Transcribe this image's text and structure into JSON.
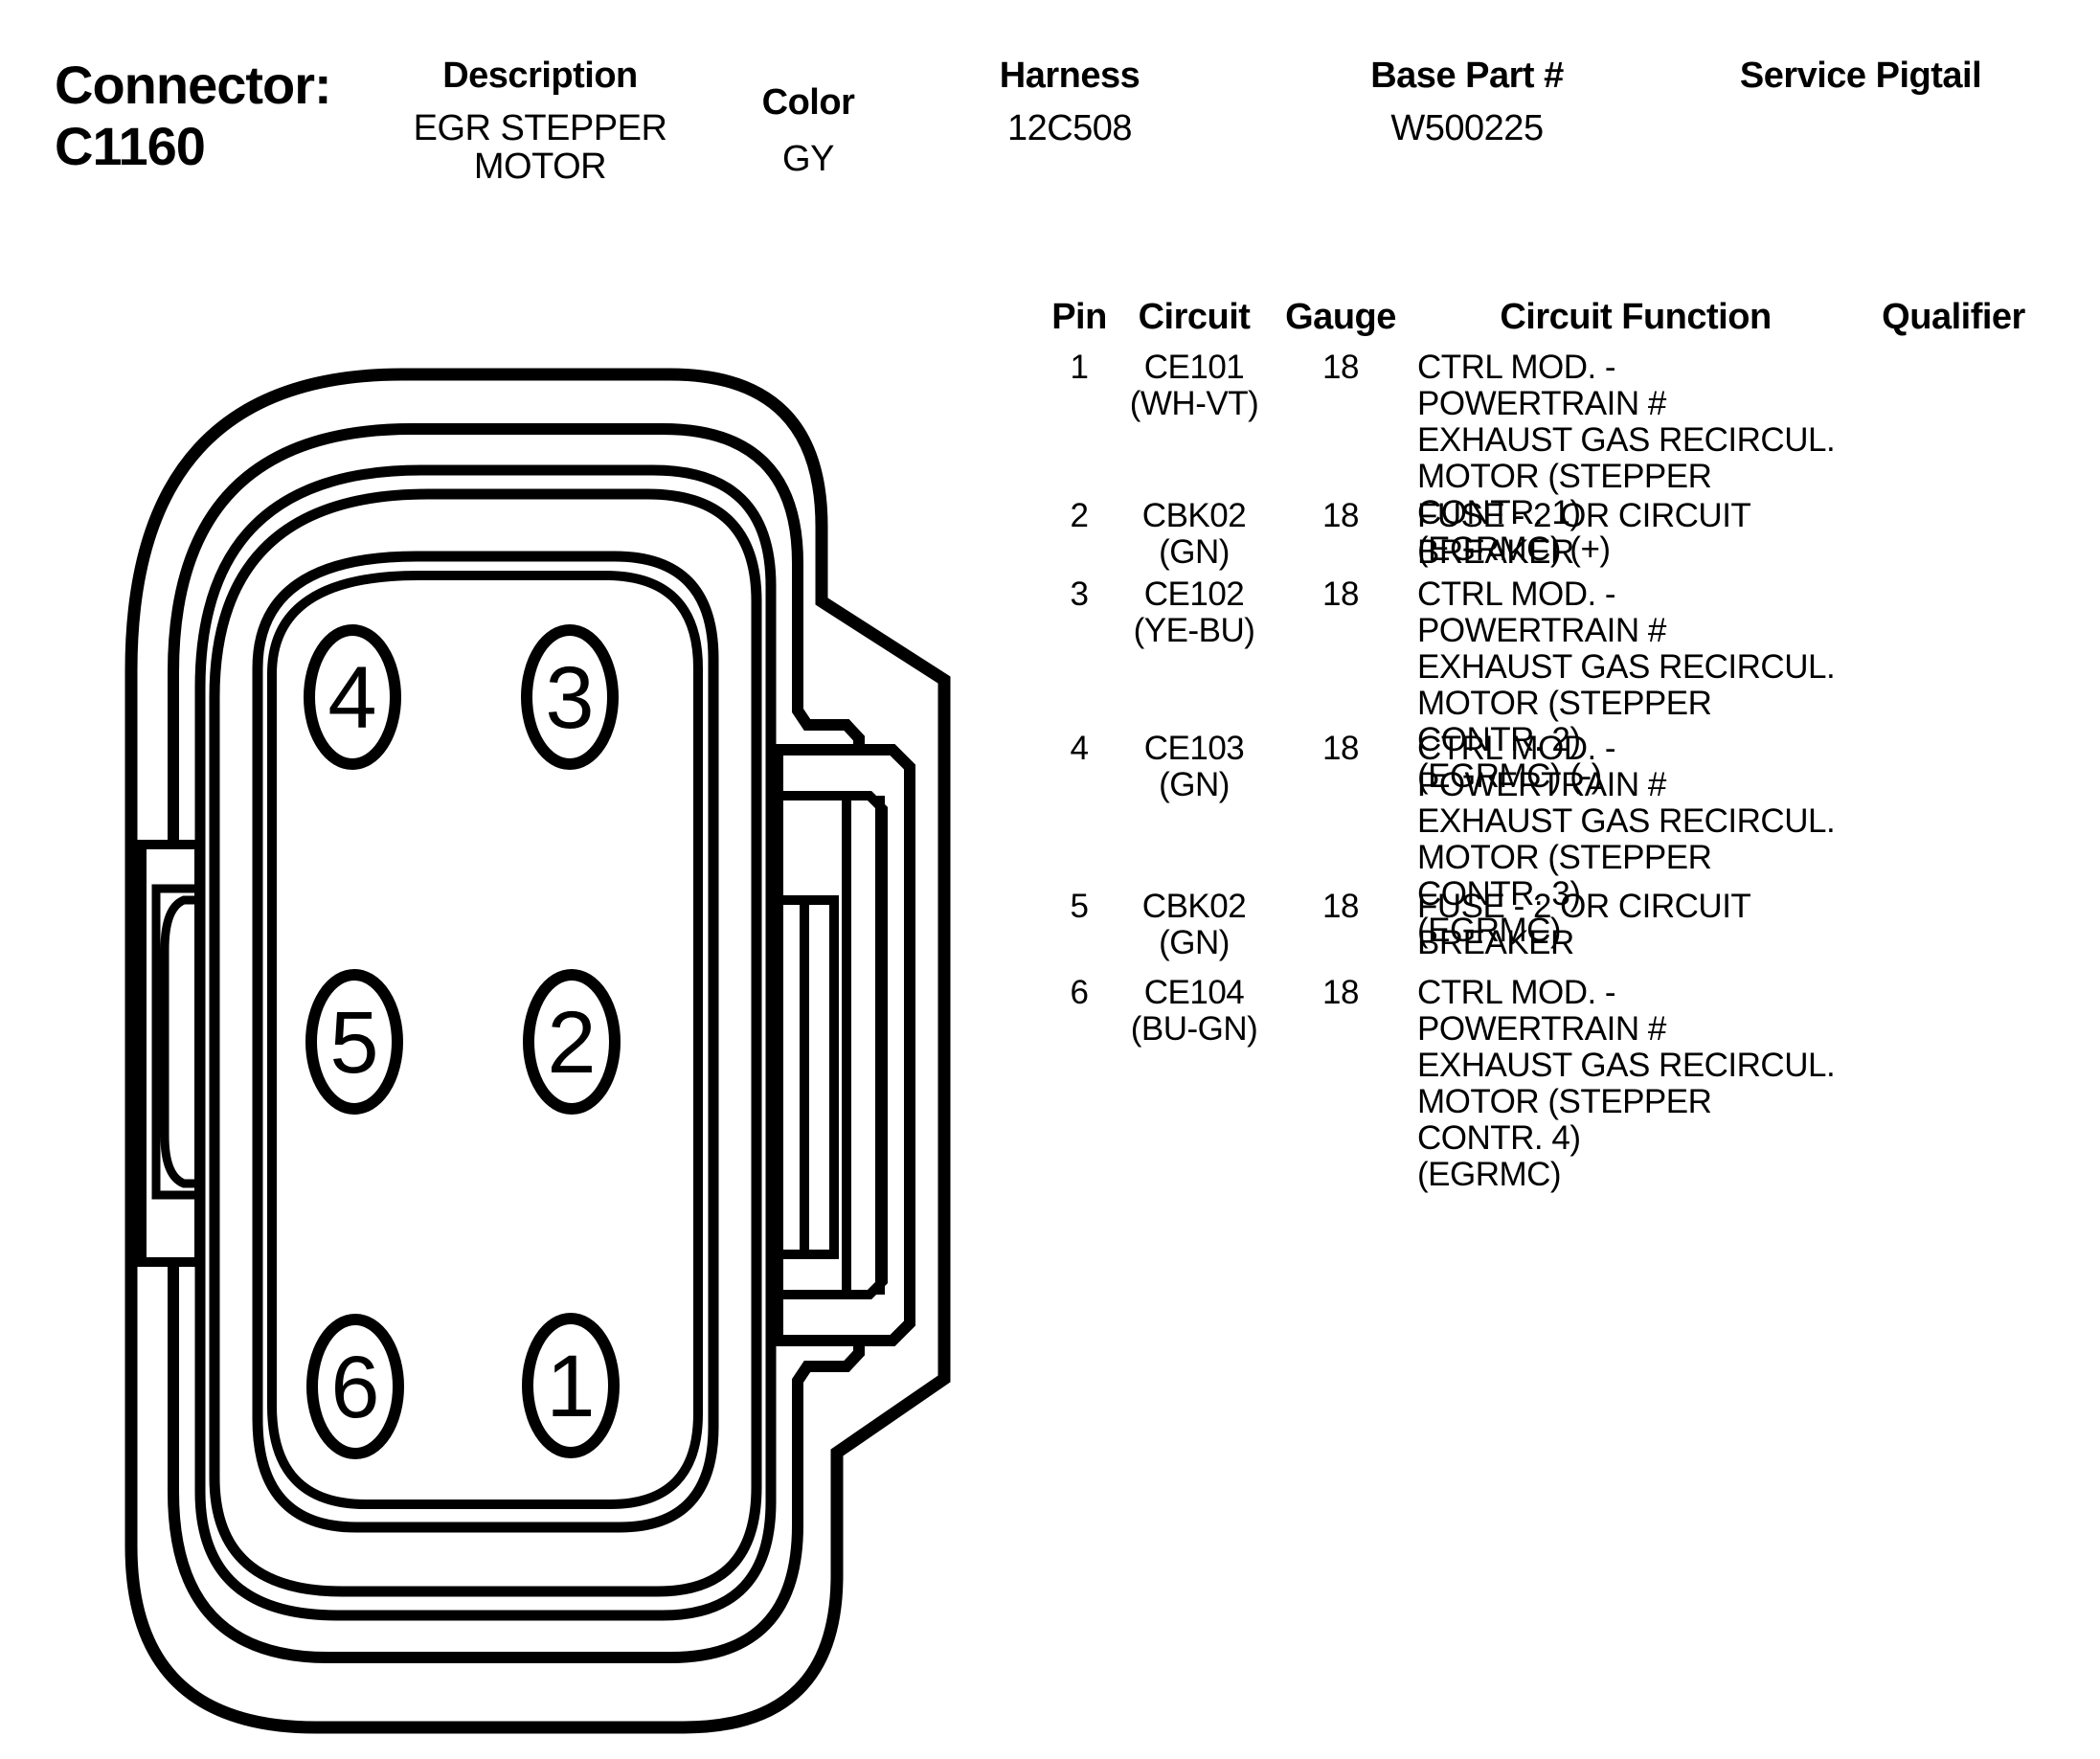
{
  "header": {
    "connector_label": "Connector:",
    "connector_id": "C1160",
    "columns": [
      {
        "label": "Description",
        "value": "EGR STEPPER\nMOTOR"
      },
      {
        "label": "Color",
        "value": "GY"
      },
      {
        "label": "Harness",
        "value": "12C508"
      },
      {
        "label": "Base Part #",
        "value": "W500225"
      },
      {
        "label": "Service Pigtail",
        "value": ""
      }
    ]
  },
  "pin_table": {
    "headers": [
      "Pin",
      "Circuit",
      "Gauge",
      "Circuit Function",
      "Qualifier"
    ],
    "rows": [
      {
        "pin": "1",
        "circuit": "CE101\n(WH-VT)",
        "gauge": "18",
        "function": "CTRL MOD. - POWERTRAIN #\nEXHAUST GAS RECIRCUL.\nMOTOR (STEPPER CONTR. 1)\n(EGRMC) (+)",
        "qualifier": ""
      },
      {
        "pin": "2",
        "circuit": "CBK02\n(GN)",
        "gauge": "18",
        "function": "FUSE - 2 OR CIRCUIT\nBREAKER",
        "qualifier": ""
      },
      {
        "pin": "3",
        "circuit": "CE102\n(YE-BU)",
        "gauge": "18",
        "function": "CTRL MOD. - POWERTRAIN #\nEXHAUST GAS RECIRCUL.\nMOTOR (STEPPER CONTR. 2)\n(EGRMC) (-)",
        "qualifier": ""
      },
      {
        "pin": "4",
        "circuit": "CE103\n(GN)",
        "gauge": "18",
        "function": "CTRL MOD. - POWERTRAIN #\nEXHAUST GAS RECIRCUL.\nMOTOR (STEPPER CONTR. 3)\n(EGRMC)",
        "qualifier": ""
      },
      {
        "pin": "5",
        "circuit": "CBK02\n(GN)",
        "gauge": "18",
        "function": "FUSE - 2 OR CIRCUIT\nBREAKER",
        "qualifier": ""
      },
      {
        "pin": "6",
        "circuit": "CE104\n(BU-GN)",
        "gauge": "18",
        "function": "CTRL MOD. - POWERTRAIN #\nEXHAUST GAS RECIRCUL.\nMOTOR (STEPPER CONTR. 4)\n(EGRMC)",
        "qualifier": ""
      }
    ]
  },
  "diagram": {
    "pins": [
      "4",
      "3",
      "5",
      "2",
      "6",
      "1"
    ],
    "line_color": "#000000",
    "background": "#ffffff"
  }
}
